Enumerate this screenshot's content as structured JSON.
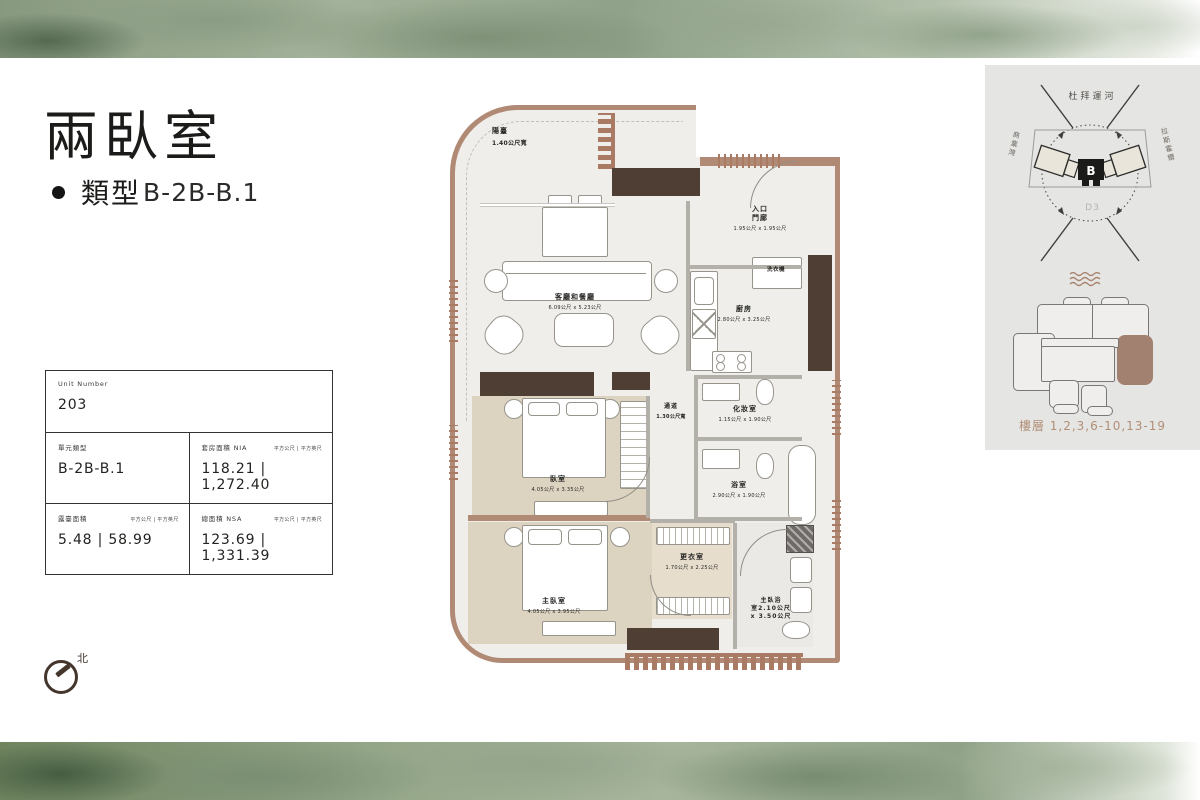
{
  "header": {
    "title": "兩臥室",
    "type_label": "類型",
    "type_value": "B-2B-B.1"
  },
  "info_table": {
    "unit_number_label": "Unit Number",
    "unit_number": "203",
    "unit_type_label": "單元類型",
    "unit_type": "B-2B-B.1",
    "suite_area_label": "套房面積 NIA",
    "suite_area_units": "平方公尺 | 平方英尺",
    "suite_area_value": "118.21   |   1,272.40",
    "terrace_area_label": "露臺面積",
    "terrace_area_units": "平方公尺 | 平方英尺",
    "terrace_area_value": "5.48   |   58.99",
    "total_area_label": "總面積 NSA",
    "total_area_units": "平方公尺 | 平方英尺",
    "total_area_value": "123.69   |   1,331.39"
  },
  "floor_plan": {
    "balcony": {
      "name": "陽臺",
      "dims": "1.40公尺寬"
    },
    "living_dining": {
      "name": "客廳和餐廳",
      "dims": "6.09公尺 x 5.23公尺"
    },
    "entry": {
      "name": "入口\n門廊",
      "dims": "1.95公尺 x 1.95公尺"
    },
    "washer": {
      "name": "洗衣機"
    },
    "kitchen": {
      "name": "廚房",
      "dims": "2.80公尺 x 3.25公尺"
    },
    "corridor": {
      "name": "通道",
      "dims": "1.30公尺寬"
    },
    "powder": {
      "name": "化妝室",
      "dims": "1.15公尺 x 1.90公尺"
    },
    "bath": {
      "name": "浴室",
      "dims": "2.90公尺 x 1.90公尺"
    },
    "bedroom": {
      "name": "臥室",
      "dims": "4.05公尺 x 3.35公尺"
    },
    "master_bedroom": {
      "name": "主臥室",
      "dims": "4.05公尺 x 3.95公尺"
    },
    "closet": {
      "name": "更衣室",
      "dims": "1.70公尺 x 2.25公尺"
    },
    "master_bath": {
      "name": "主臥浴\n室2.10公尺\nx 3.50公尺"
    }
  },
  "key_plan": {
    "canal_label": "杜拜運河",
    "left_label": "商業灣",
    "right_label": "拉斯霍爾",
    "district_label": "D3",
    "building_label": "B",
    "floors_label": "樓層 1,2,3,6-10,13-19"
  },
  "compass": {
    "north_label": "北"
  }
}
